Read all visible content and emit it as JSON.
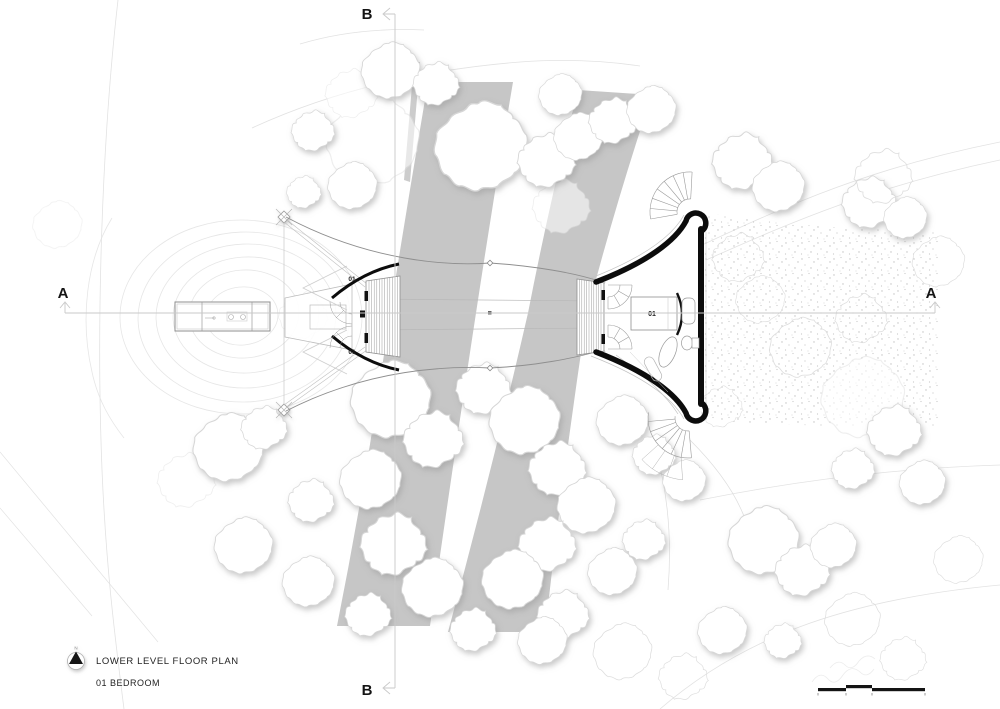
{
  "title_block": {
    "plan_title": "LOWER LEVEL FLOOR PLAN",
    "plan_subtitle": "01 BEDROOM",
    "north_label": "N"
  },
  "section_markers": {
    "top": "B",
    "bottom": "B",
    "left": "A",
    "right": "A"
  },
  "plan_labels": {
    "wall_label_top": "01",
    "wall_label_bottom": "01",
    "bedroom_number": "01"
  },
  "colors": {
    "paper": "#ffffff",
    "band_gray": "#c6c6c6",
    "wall_black": "#0c0c0c",
    "section_line": "#c9c9c9",
    "contour_line": "#e6e6e6",
    "tree_outline": "#d6d6d6",
    "tree_shadow": "#9b9b9b",
    "stipple_dot": "#c2c2c2",
    "text": "#232323"
  }
}
